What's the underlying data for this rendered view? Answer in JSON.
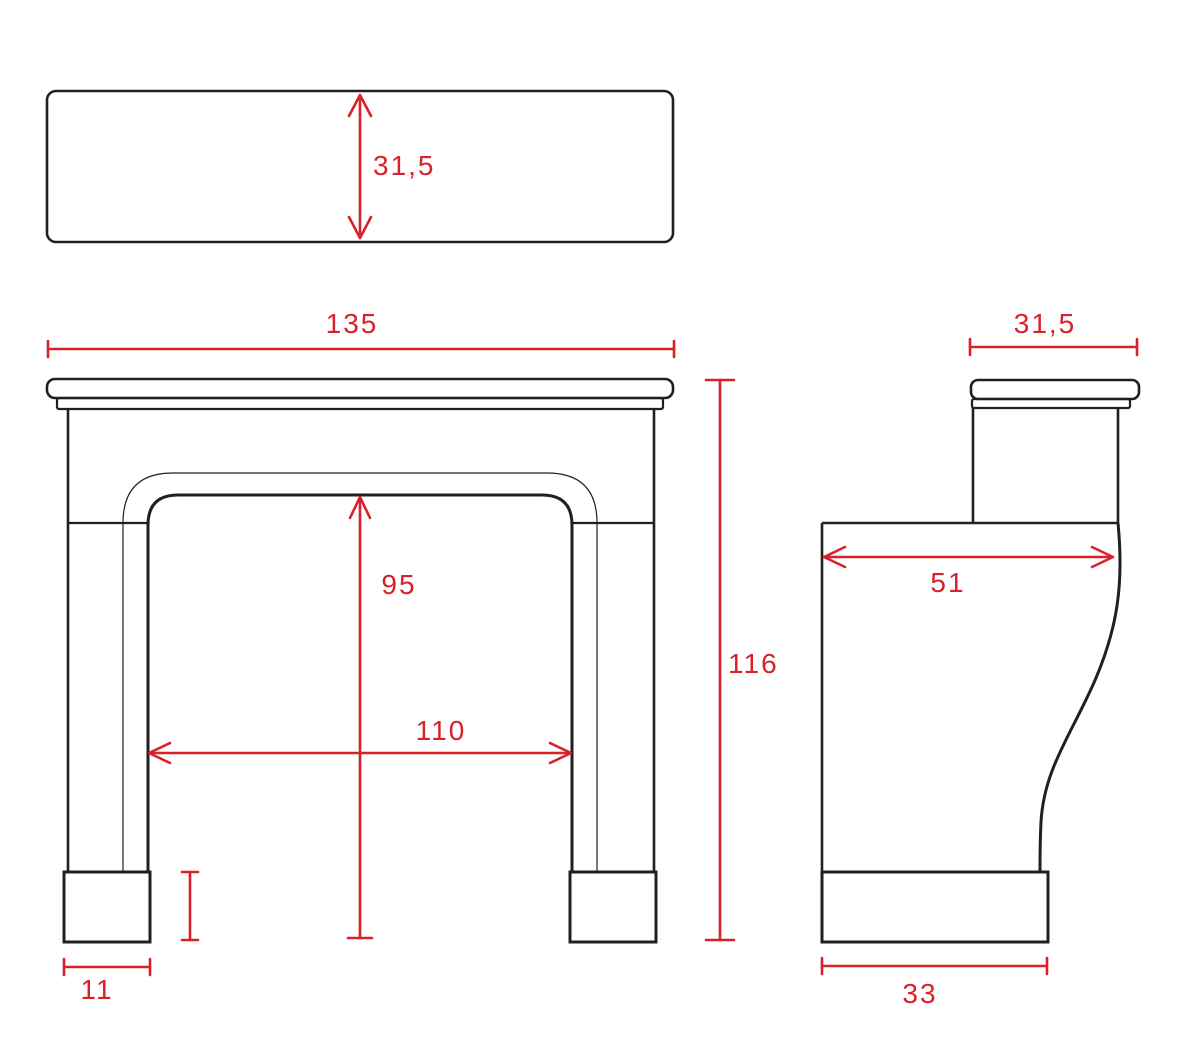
{
  "drawing": {
    "type": "technical-dimension-drawing",
    "subject": "fireplace-mantel-surround",
    "background_color": "#ffffff",
    "outline_color": "#231f20",
    "dimension_color": "#d8222a",
    "views": {
      "top": {
        "name": "shelf plan view",
        "depth_label": "31,5"
      },
      "front": {
        "name": "front elevation",
        "overall_width_label": "135",
        "overall_height_label": "116",
        "opening_height_label": "95",
        "opening_width_label": "110",
        "plinth_width_label": "11"
      },
      "side": {
        "name": "side elevation",
        "shelf_depth_label": "31,5",
        "body_depth_label": "51",
        "plinth_depth_label": "33"
      }
    }
  }
}
